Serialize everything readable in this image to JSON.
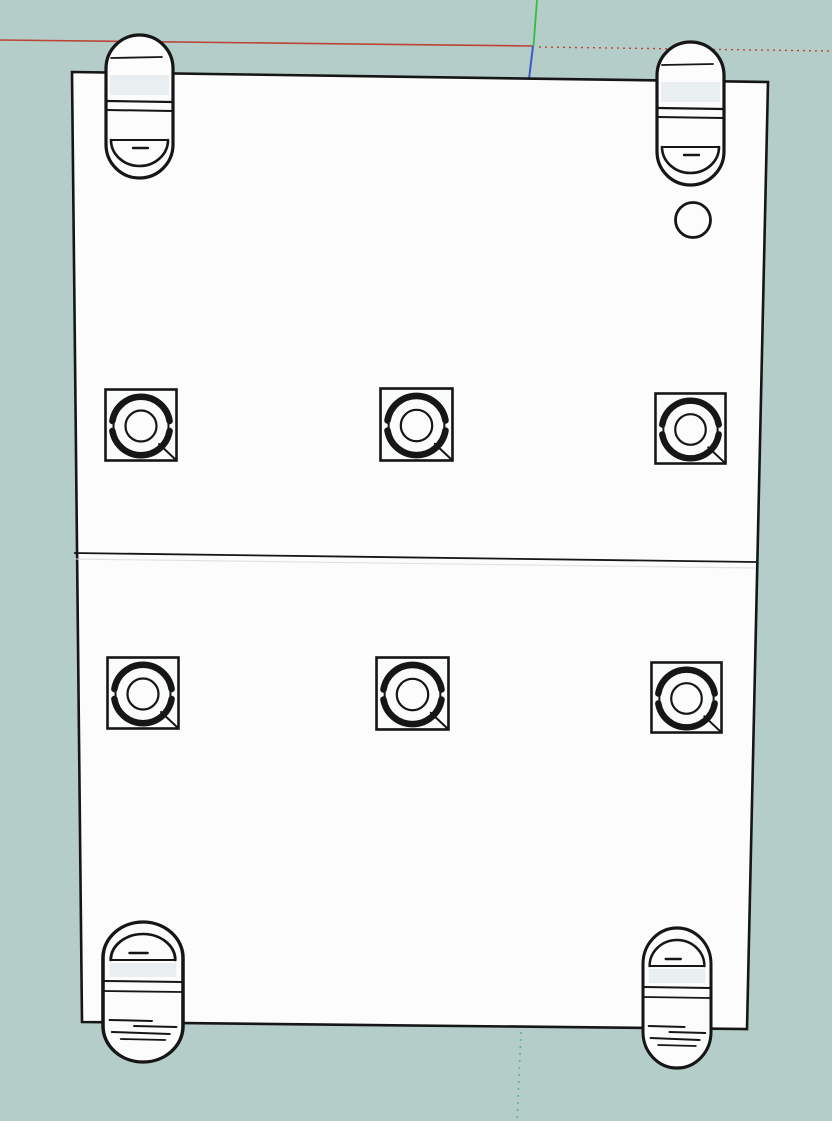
{
  "window": {
    "width": 832,
    "height": 1121
  },
  "viewport": {
    "tool_hint": "",
    "background": "#b5cdc9"
  },
  "colors": {
    "background": "#b5cdc9",
    "plate": "#fcfcfd",
    "boss": "#fafbfb",
    "shade": "#e9eef0",
    "edge": "#161616",
    "seam_echo": "#d8dedd",
    "axis_red": "#bb4436",
    "axis_green": "#2fbf44",
    "axis_green_dotted": "#57b97a",
    "axis_blue": "#3d59c6"
  },
  "scene": {
    "axes": [
      {
        "name": "red-axis-solid",
        "color": "axis_red",
        "x1": 0,
        "y1": 40,
        "x2": 533,
        "y2": 46,
        "w": 1.6
      },
      {
        "name": "red-axis-dotted",
        "color": "axis_red",
        "x1": 539,
        "y1": 47,
        "x2": 832,
        "y2": 51,
        "w": 1.4,
        "dash": "2 4"
      },
      {
        "name": "green-axis-solid",
        "color": "axis_green",
        "x1": 537,
        "y1": 0,
        "x2": 533.5,
        "y2": 46,
        "w": 1.8
      },
      {
        "name": "blue-axis-solid",
        "color": "axis_blue",
        "x1": 533,
        "y1": 46,
        "x2": 529,
        "y2": 79,
        "w": 2
      },
      {
        "name": "green-axis-dotted",
        "color": "axis_green_dotted",
        "x1": 521,
        "y1": 1032,
        "x2": 517,
        "y2": 1121,
        "w": 1.6,
        "dash": "2 5"
      }
    ],
    "plate": {
      "corners": "72,72 768,82 747,1029 82,1022",
      "stroke_width": 2.6
    },
    "seam": {
      "x1": 74,
      "y1": 553,
      "x2": 756,
      "y2": 562,
      "echo_offset": 6
    },
    "hole": {
      "cx": 693,
      "cy": 220,
      "r": 17.5,
      "stroke_width": 2.8
    },
    "clips": [
      {
        "name": "mounting-clip-top-left",
        "kind": "top",
        "x": 106,
        "y": 35,
        "w": 67,
        "h": 143
      },
      {
        "name": "mounting-clip-top-right",
        "kind": "top",
        "x": 657,
        "y": 42,
        "w": 67,
        "h": 143
      },
      {
        "name": "mounting-clip-bottom-left",
        "kind": "bottom",
        "x": 103,
        "y": 922,
        "w": 80,
        "h": 140
      },
      {
        "name": "mounting-clip-bottom-right",
        "kind": "bottom",
        "x": 643,
        "y": 928,
        "w": 68,
        "h": 140
      }
    ],
    "bosses": [
      {
        "name": "twist-lock-boss-row1-left",
        "x": 104,
        "y": 388,
        "s": 74
      },
      {
        "name": "twist-lock-boss-row1-center",
        "x": 379,
        "y": 387,
        "s": 75
      },
      {
        "name": "twist-lock-boss-row1-right",
        "x": 654,
        "y": 392,
        "s": 73
      },
      {
        "name": "twist-lock-boss-row2-left",
        "x": 106,
        "y": 656,
        "s": 74
      },
      {
        "name": "twist-lock-boss-row2-center",
        "x": 375,
        "y": 656,
        "s": 75
      },
      {
        "name": "twist-lock-boss-row2-right",
        "x": 650,
        "y": 661,
        "s": 73
      }
    ]
  }
}
